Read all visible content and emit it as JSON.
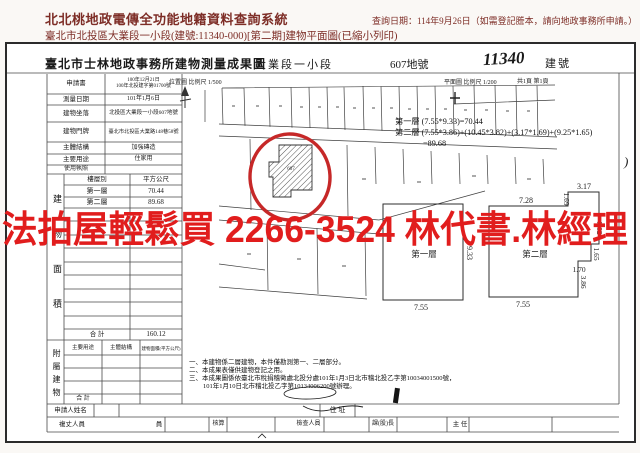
{
  "header": {
    "system_title": "北北桃地政電傳全功能地籍資料查詢系統",
    "query_date": "查詢日期：114年9月26日（如需登記謄本，請向地政事務所申請。）",
    "document_title": "臺北市北投區大業段一小段(建號:11340-000)[第二期]建物平面圖(已縮小列印)"
  },
  "watermark": {
    "text": "法拍屋輕鬆買 2266-3524 林代書.林經理",
    "color": "#e11d1d"
  },
  "form": {
    "title": "臺北市士林地政事務所建物測量成果圖",
    "section_name": "大業段一小段",
    "land_number": "607地號",
    "building_number": "11340",
    "building_number_label": "建號",
    "location_map_scale": "位置圖 比例尺 1/500",
    "floor_plan_scale": "平面圖 比例尺 1/200",
    "page_count": "共1頁 第1頁",
    "margin_mark": ")"
  },
  "info_rows": [
    {
      "label": "申請書",
      "value": "100年12月21日",
      "value2": "100年北投建字第01700號"
    },
    {
      "label": "測量日期",
      "value": "101年1月6日"
    },
    {
      "label": "建物坐落",
      "value": "北投區大業段一小段607地號"
    },
    {
      "label": "建物門牌",
      "value": "臺北市北投區大業路148巷58號"
    },
    {
      "label": "主體結構",
      "value": "加強磚造"
    },
    {
      "label": "主要用途",
      "value": "住家用"
    },
    {
      "label": "使用執照",
      "value": ""
    }
  ],
  "floor_area": {
    "side_label": "建物面積",
    "col_floor": "樓層別",
    "col_area": "平方公尺",
    "rows": [
      {
        "floor": "第一層",
        "area": "70.44"
      },
      {
        "floor": "第二層",
        "area": "89.68"
      }
    ],
    "total_label": "合 計",
    "total_value": "160.12"
  },
  "annex": {
    "side_label": "附屬建物",
    "col_use": "主要用途",
    "col_structure": "主體結構",
    "col_area": "建物面積(平方公尺)",
    "total_label": "合 計"
  },
  "footer": {
    "applicant_label": "申請人姓名",
    "address_label": "住 址",
    "officials": [
      "複丈人員",
      "員",
      "核算",
      "檢查人員",
      "課(股)長",
      "主 任"
    ]
  },
  "calculations": {
    "line1": "第一層 (7.55*9.33)=70.44",
    "line2": "第二層 (7.55*3.86)+(10.45*3.82)+(3.17*1.69)+(9.25*1.65)",
    "line3": "=89.68"
  },
  "notes": [
    "一、本建物係二層建物，本件僅勘測第一、二層部分。",
    "二、本成果表僅供建物登記之用。",
    "三、本成果圖係依臺北市稅捐稽徵處北投分處101年1月3日北市稽北投乙字第10034001500號，",
    "101年1月10日北市稽北投乙字第10134006200號辦理。"
  ],
  "location_map": {
    "lot_label": "607"
  },
  "plan_first": {
    "label": "第一層",
    "dim_width": "7.55",
    "dim_height": "9.33"
  },
  "plan_second": {
    "label": "第二層",
    "dim_top": "7.28",
    "dim_top_right": "3.17",
    "dim_r1": "1.69",
    "dim_r2": "3.82",
    "dim_r3": "1.65",
    "dim_r4": "1.70",
    "dim_r5": "3.86",
    "dim_bottom": "7.55"
  }
}
